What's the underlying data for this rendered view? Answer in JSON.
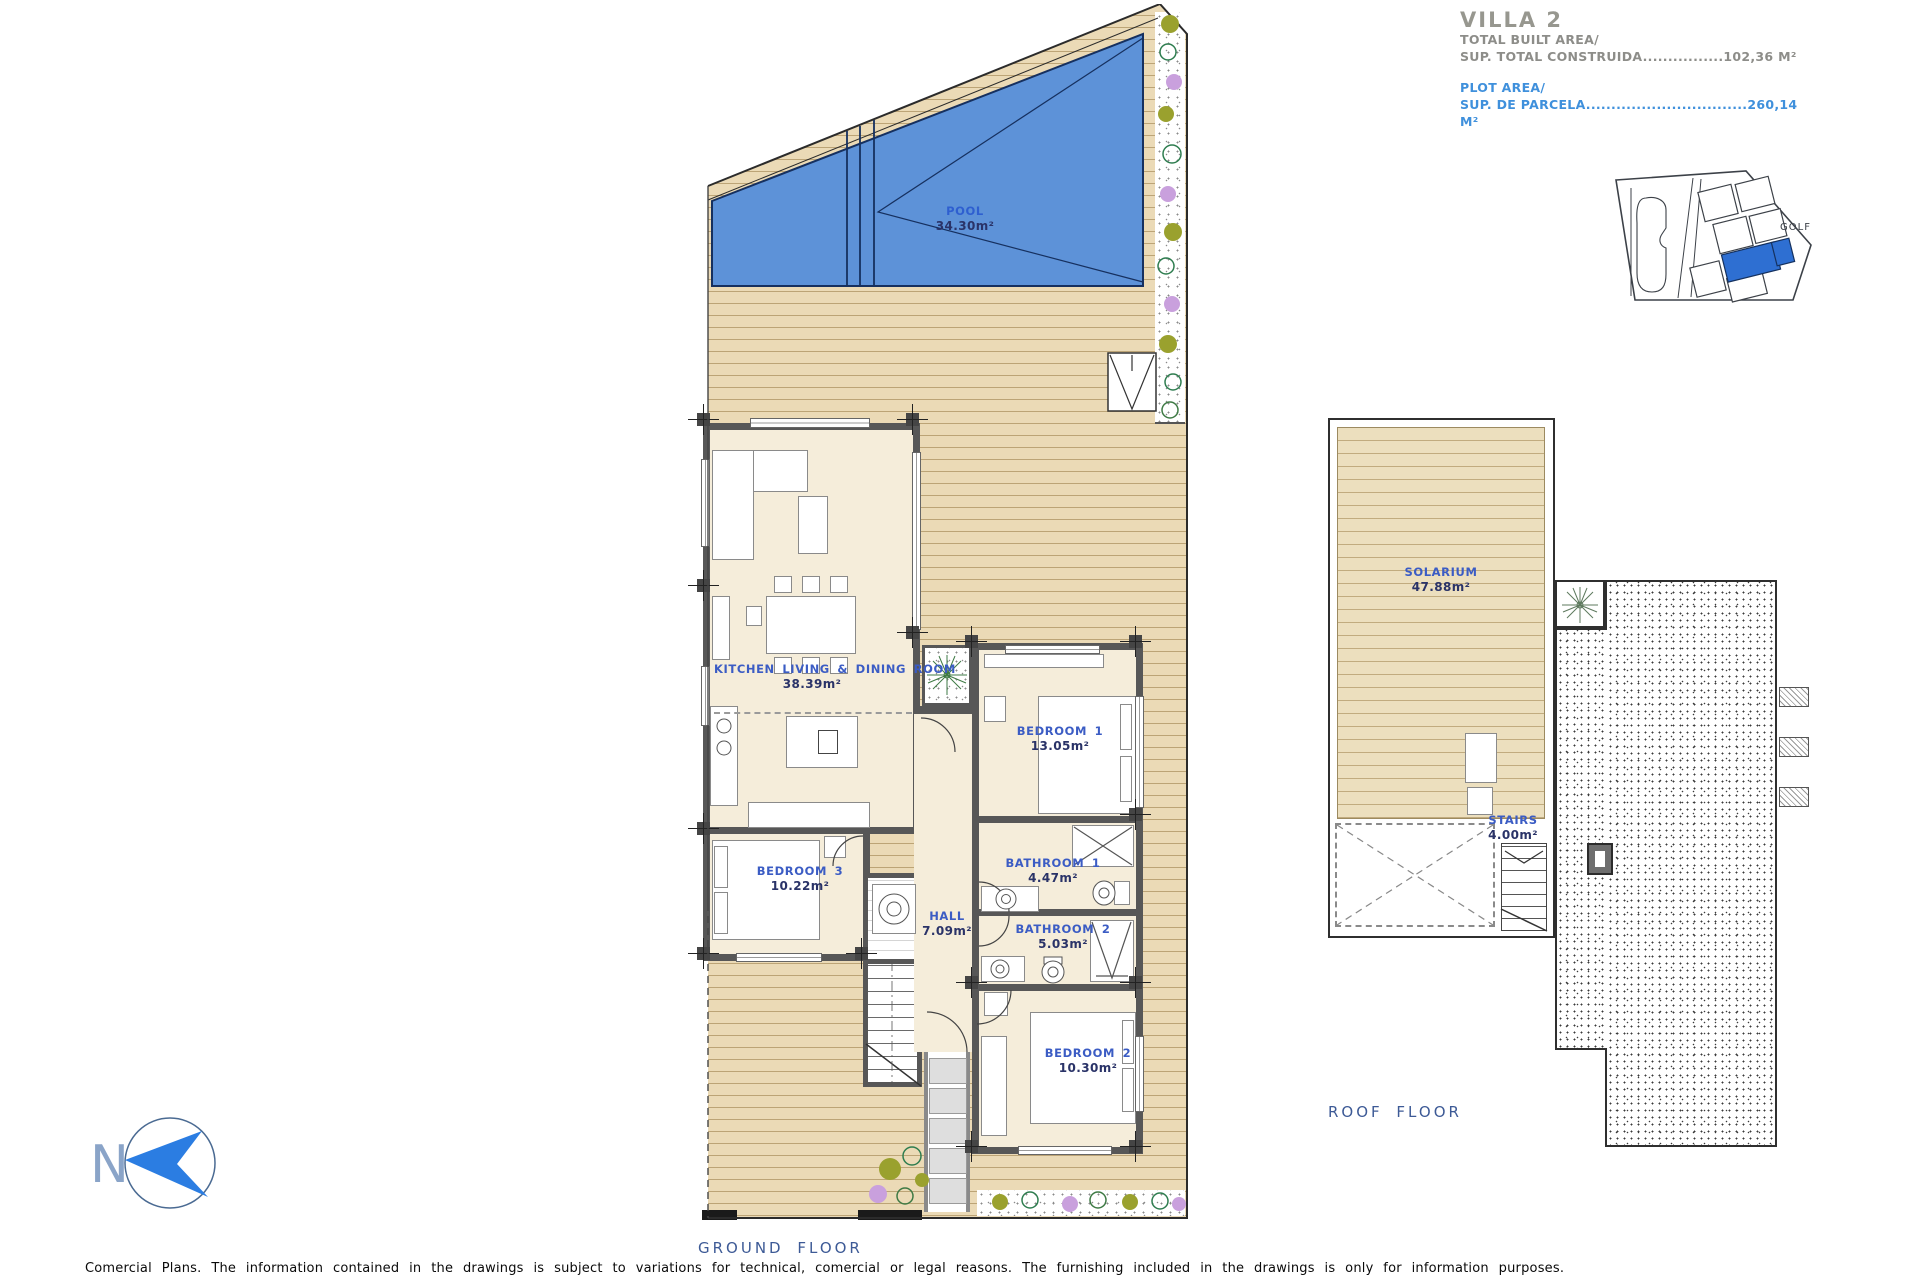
{
  "title_block": {
    "villa": "VILLA 2",
    "built_area_label": "TOTAL BUILT AREA/",
    "built_area_row": "SUP. TOTAL CONSTRUIDA................102,36 M²",
    "plot_area_label": "PLOT AREA/",
    "plot_area_row": "SUP. DE PARCELA................................260,14 M²"
  },
  "site_map": {
    "golf": "GOLF"
  },
  "compass": {
    "north": "N"
  },
  "ground_floor": {
    "caption": "GROUND FLOOR",
    "pool": {
      "name": "POOL",
      "area": "34.30m²"
    },
    "kitchen": {
      "name": "KITCHEN LIVING & DINING ROOM",
      "area": "38.39m²"
    },
    "bedroom1": {
      "name": "BEDROOM 1",
      "area": "13.05m²"
    },
    "bedroom2": {
      "name": "BEDROOM 2",
      "area": "10.30m²"
    },
    "bedroom3": {
      "name": "BEDROOM 3",
      "area": "10.22m²"
    },
    "bathroom1": {
      "name": "BATHROOM 1",
      "area": "4.47m²"
    },
    "bathroom2": {
      "name": "BATHROOM 2",
      "area": "5.03m²"
    },
    "hall": {
      "name": "HALL",
      "area": "7.09m²"
    }
  },
  "roof_floor": {
    "caption": "ROOF FLOOR",
    "solarium": {
      "name": "SOLARIUM",
      "area": "47.88m²"
    },
    "stairs": {
      "name": "STAIRS",
      "area": "4.00m²"
    }
  },
  "footer": {
    "disclaimer": "Comercial Plans. The information contained in the drawings is subject to variations for technical, comercial or legal reasons. The furnishing included in the drawings is only for information purposes."
  },
  "colors": {
    "pool": "#5d92d8",
    "deck": "#ebdab6",
    "wall": "#575757",
    "room_name_blue": "#3b5cc4",
    "title_blue": "#3f90dc",
    "title_gray": "#97978f",
    "caption_blue": "#3d5a96",
    "site_highlight": "#2e6fd2"
  }
}
